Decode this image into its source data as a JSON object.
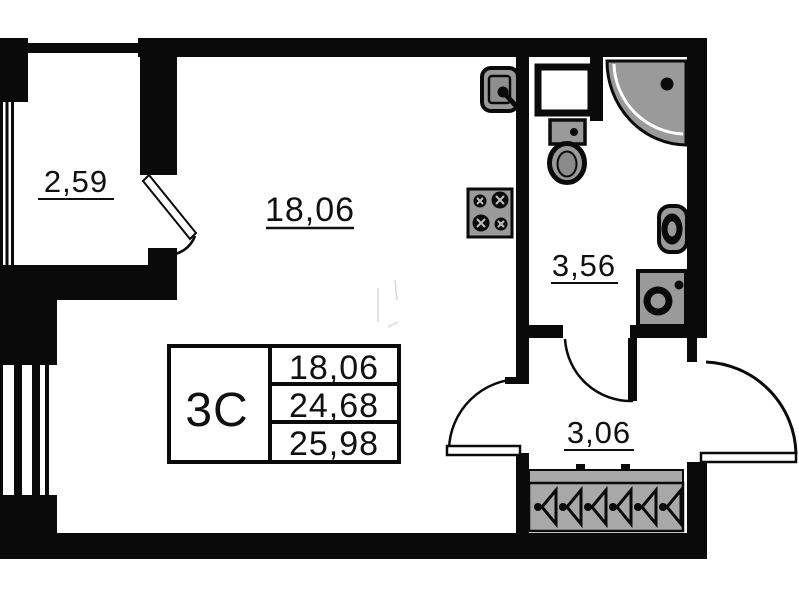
{
  "plan": {
    "rooms": {
      "balcony": {
        "area": "2,59"
      },
      "living_room": {
        "area": "18,06"
      },
      "bathroom": {
        "area": "3,56"
      },
      "hallway": {
        "area": "3,06"
      }
    },
    "info_table": {
      "unit_type": "3С",
      "living_area": "18,06",
      "area_no_balcony": "24,68",
      "total_area": "25,98"
    },
    "fixtures": [
      "kitchen-sink",
      "duct-box",
      "toilet",
      "corner-shower",
      "washbasin",
      "washing-machine",
      "stove",
      "wardrobe-hangers"
    ],
    "colors": {
      "wall": "#0a0a0a",
      "fixture": "#9a9a9a",
      "background": "#ffffff"
    }
  }
}
